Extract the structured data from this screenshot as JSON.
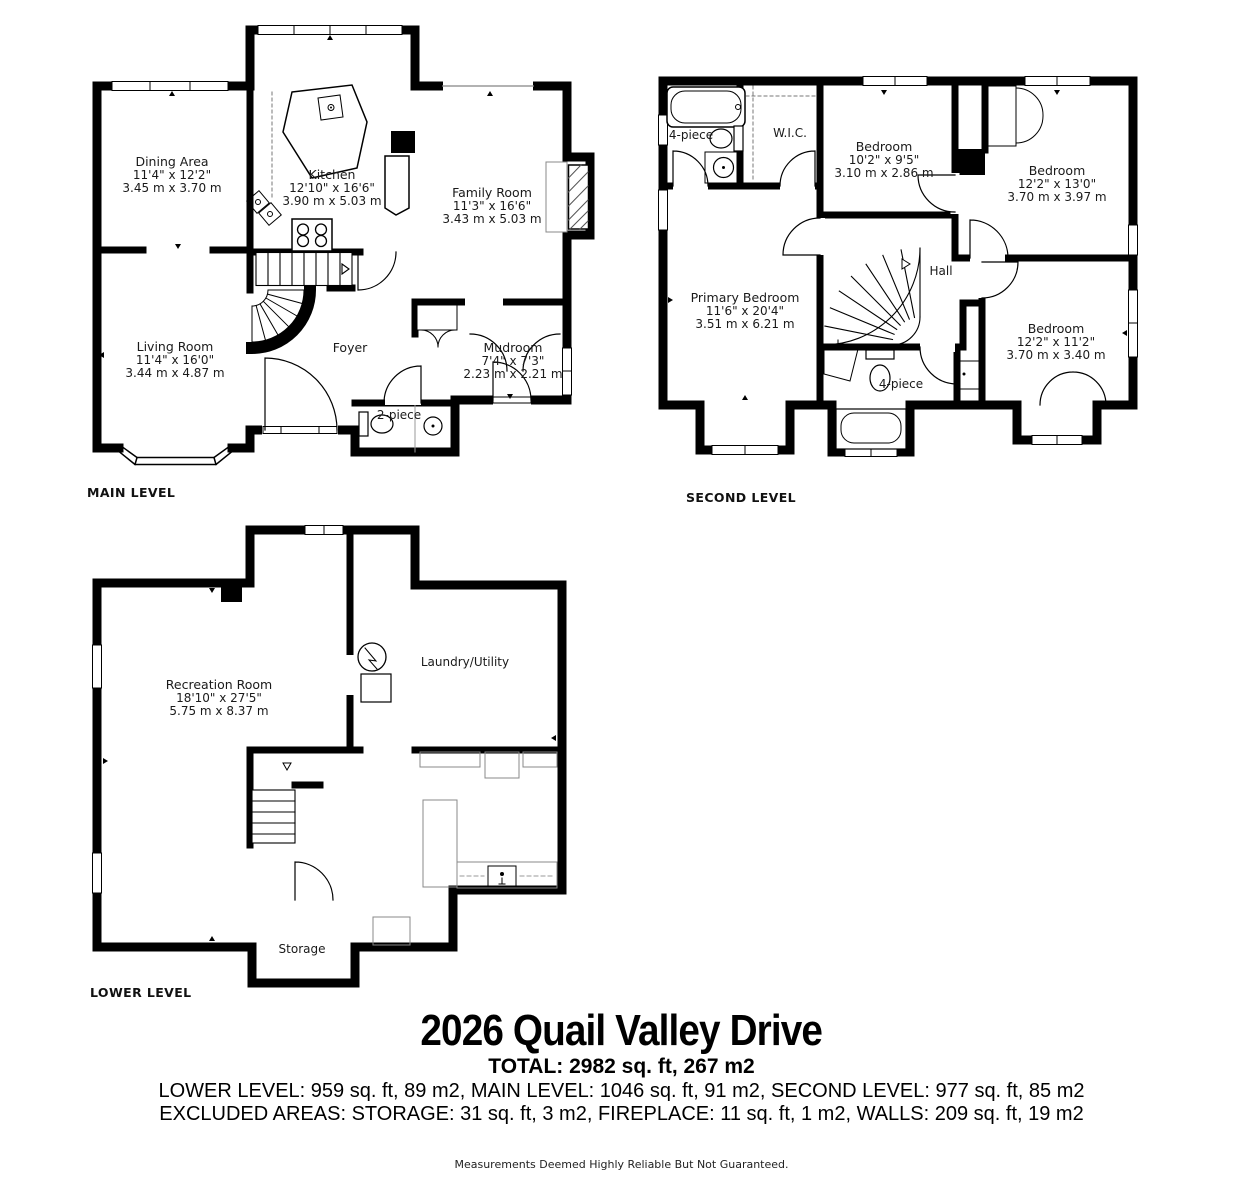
{
  "colors": {
    "walls": "#000000",
    "background": "#ffffff",
    "fixtures": "#888888"
  },
  "levels": [
    {
      "name": "MAIN LEVEL",
      "rooms": [
        {
          "name": "Dining Area",
          "dims_ft": "11'4\" x 12'2\"",
          "dims_m": "3.45 m x 3.70 m"
        },
        {
          "name": "Kitchen",
          "dims_ft": "12'10\" x 16'6\"",
          "dims_m": "3.90 m x 5.03 m"
        },
        {
          "name": "Family Room",
          "dims_ft": "11'3\" x 16'6\"",
          "dims_m": "3.43 m x 5.03 m"
        },
        {
          "name": "Living Room",
          "dims_ft": "11'4\" x 16'0\"",
          "dims_m": "3.44 m x 4.87 m"
        },
        {
          "name": "Foyer"
        },
        {
          "name": "Mudroom",
          "dims_ft": "7'4\" x 7'3\"",
          "dims_m": "2.23 m x 2.21 m"
        },
        {
          "name": "2-piece"
        }
      ]
    },
    {
      "name": "SECOND LEVEL",
      "rooms": [
        {
          "name": "4-piece"
        },
        {
          "name": "W.I.C."
        },
        {
          "name": "Bedroom",
          "dims_ft": "10'2\" x 9'5\"",
          "dims_m": "3.10 m x 2.86 m"
        },
        {
          "name": "Bedroom",
          "dims_ft": "12'2\" x 13'0\"",
          "dims_m": "3.70 m x 3.97 m"
        },
        {
          "name": "Primary Bedroom",
          "dims_ft": "11'6\" x 20'4\"",
          "dims_m": "3.51 m x 6.21 m"
        },
        {
          "name": "Hall"
        },
        {
          "name": "Bedroom",
          "dims_ft": "12'2\" x 11'2\"",
          "dims_m": "3.70 m x 3.40 m"
        },
        {
          "name": "4-piece"
        }
      ]
    },
    {
      "name": "LOWER LEVEL",
      "rooms": [
        {
          "name": "Recreation Room",
          "dims_ft": "18'10\" x 27'5\"",
          "dims_m": "5.75 m x 8.37 m"
        },
        {
          "name": "Laundry/Utility"
        },
        {
          "name": "Storage"
        }
      ]
    }
  ],
  "footer": {
    "title": "2026 Quail Valley Drive",
    "total": "TOTAL: 2982 sq. ft, 267 m2",
    "levels_line": "LOWER LEVEL: 959 sq. ft, 89 m2, MAIN LEVEL: 1046 sq. ft, 91 m2, SECOND LEVEL: 977 sq. ft, 85 m2",
    "excluded_line": "EXCLUDED AREAS: STORAGE: 31 sq. ft, 3 m2, FIREPLACE: 11 sq. ft, 1 m2, WALLS: 209 sq. ft, 19 m2",
    "disclaimer": "Measurements Deemed Highly Reliable But Not Guaranteed."
  }
}
